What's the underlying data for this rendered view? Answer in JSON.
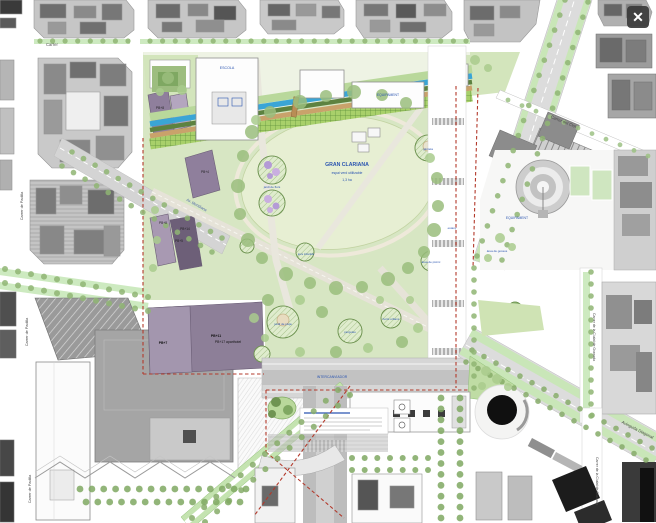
{
  "viewer": {
    "close_label": "✕"
  },
  "plan": {
    "title": "Pla urbanístic Glòries",
    "labels": [
      {
        "id": "carrer-top",
        "text": "Carrer",
        "x": 46,
        "y": 46,
        "rot": 0,
        "size": 4.2,
        "color": "#555555",
        "bold": false,
        "anchor": "start"
      },
      {
        "id": "carrer-del-clot",
        "text": "Carrer del Clot",
        "x": 563,
        "y": 123,
        "rot": 22,
        "size": 4.2,
        "color": "#4a4a4a",
        "bold": false,
        "anchor": "middle"
      },
      {
        "id": "carrer-padilla-1",
        "text": "Carrer de Padilla",
        "x": 23,
        "y": 206,
        "rot": -90,
        "size": 3.8,
        "color": "#4a4a4a",
        "bold": false,
        "anchor": "middle"
      },
      {
        "id": "carrer-padilla-2",
        "text": "Carrer de Padilla",
        "x": 28,
        "y": 332,
        "rot": -90,
        "size": 3.8,
        "color": "#4a4a4a",
        "bold": false,
        "anchor": "middle"
      },
      {
        "id": "carrer-padilla-3",
        "text": "Carrer de Padilla",
        "x": 31,
        "y": 489,
        "rot": -90,
        "size": 3.8,
        "color": "#4a4a4a",
        "bold": false,
        "anchor": "middle"
      },
      {
        "id": "carrer-granada-1",
        "text": "Carrer de la Ciutat de Granada",
        "x": 593,
        "y": 337,
        "rot": 90,
        "size": 3.5,
        "color": "#4a4a4a",
        "bold": false,
        "anchor": "middle"
      },
      {
        "id": "carrer-granada-2",
        "text": "Carrer de la Ciutat de Granada",
        "x": 596,
        "y": 481,
        "rot": 90,
        "size": 3.5,
        "color": "#4a4a4a",
        "bold": false,
        "anchor": "middle"
      },
      {
        "id": "avinguda-diagonal",
        "text": "Avinguda Diagonal",
        "x": 637,
        "y": 431,
        "rot": 27,
        "size": 4.2,
        "color": "#4a4a4a",
        "bold": false,
        "anchor": "middle"
      },
      {
        "id": "av-meridiana",
        "text": "Av. Meridiana",
        "x": 196,
        "y": 206,
        "rot": 29,
        "size": 3.8,
        "color": "#4a63a8",
        "bold": false,
        "anchor": "middle"
      },
      {
        "id": "gran-clariana-title",
        "text": "GRAN CLARIANA",
        "x": 347,
        "y": 166,
        "rot": 0,
        "size": 5.2,
        "color": "#2b55b0",
        "bold": true,
        "anchor": "middle"
      },
      {
        "id": "gran-clariana-sub",
        "text": "espai verd utilitzable",
        "x": 347,
        "y": 174,
        "rot": 0,
        "size": 3.4,
        "color": "#2b55b0",
        "bold": false,
        "anchor": "middle"
      },
      {
        "id": "gran-clariana-area",
        "text": "1,3 ha",
        "x": 347,
        "y": 181,
        "rot": 0,
        "size": 3.4,
        "color": "#2b55b0",
        "bold": false,
        "anchor": "middle"
      },
      {
        "id": "escola",
        "text": "ESCOLA",
        "x": 227,
        "y": 69,
        "rot": 0,
        "size": 3.6,
        "color": "#2b55b0",
        "bold": false,
        "anchor": "middle"
      },
      {
        "id": "equipament-1",
        "text": "EQUIPAMENT",
        "x": 388,
        "y": 96,
        "rot": 0,
        "size": 3.4,
        "color": "#2b55b0",
        "bold": false,
        "anchor": "middle"
      },
      {
        "id": "equipament-2",
        "text": "EQUIPAMENT",
        "x": 517,
        "y": 219,
        "rot": 0,
        "size": 3.4,
        "color": "#2b55b0",
        "bold": false,
        "anchor": "middle"
      },
      {
        "id": "intercanviador",
        "text": "INTERCANVIADOR",
        "x": 332,
        "y": 378,
        "rot": 0,
        "size": 3.4,
        "color": "#2b55b0",
        "bold": false,
        "anchor": "middle"
      },
      {
        "id": "pb8-top",
        "text": "PB+8",
        "x": 160,
        "y": 109,
        "rot": 0,
        "size": 3.3,
        "color": "#1e1e1e",
        "bold": false,
        "anchor": "middle"
      },
      {
        "id": "pb4",
        "text": "PB+4",
        "x": 205,
        "y": 173,
        "rot": 0,
        "size": 3.2,
        "color": "#1e1e1e",
        "bold": false,
        "anchor": "middle"
      },
      {
        "id": "pb8",
        "text": "PB+8",
        "x": 163,
        "y": 224,
        "rot": 0,
        "size": 3.2,
        "color": "#1e1e1e",
        "bold": false,
        "anchor": "middle"
      },
      {
        "id": "pb14",
        "text": "PB+14",
        "x": 185,
        "y": 230,
        "rot": 0,
        "size": 3.2,
        "color": "#1e1e1e",
        "bold": false,
        "anchor": "middle"
      },
      {
        "id": "pb5",
        "text": "PB+5",
        "x": 179,
        "y": 242,
        "rot": 0,
        "size": 3.2,
        "color": "#1e1e1e",
        "bold": false,
        "anchor": "middle"
      },
      {
        "id": "pb7",
        "text": "PB+7",
        "x": 163,
        "y": 344,
        "rot": 0,
        "size": 3.4,
        "color": "#111111",
        "bold": true,
        "anchor": "middle"
      },
      {
        "id": "pb11",
        "text": "PB+11",
        "x": 216,
        "y": 337,
        "rot": 0,
        "size": 3.4,
        "color": "#111111",
        "bold": true,
        "anchor": "middle"
      },
      {
        "id": "pb17",
        "text": "PB+17 aparthotel",
        "x": 228,
        "y": 343,
        "rot": 0,
        "size": 3.4,
        "color": "#111111",
        "bold": false,
        "anchor": "middle"
      },
      {
        "id": "jocs-infantils",
        "text": "jocs infantils",
        "x": 306,
        "y": 255,
        "rot": 0,
        "size": 3,
        "color": "#2b55b0",
        "bold": false,
        "anchor": "middle"
      },
      {
        "id": "jardi-pluja",
        "text": "jardí de pluja",
        "x": 283,
        "y": 325,
        "rot": 0,
        "size": 3,
        "color": "#2b55b0",
        "bold": false,
        "anchor": "middle"
      },
      {
        "id": "pergoles",
        "text": "pèrgoles",
        "x": 350,
        "y": 333,
        "rot": 0,
        "size": 3,
        "color": "#2b55b0",
        "bold": false,
        "anchor": "middle"
      },
      {
        "id": "horts-urbans",
        "text": "horts urbans",
        "x": 391,
        "y": 320,
        "rot": 0,
        "size": 3,
        "color": "#2b55b0",
        "bold": false,
        "anchor": "middle"
      },
      {
        "id": "estany",
        "text": "estany",
        "x": 452,
        "y": 229,
        "rot": 0,
        "size": 3,
        "color": "#2b55b0",
        "bold": false,
        "anchor": "middle"
      },
      {
        "id": "glorieta",
        "text": "glorieta",
        "x": 428,
        "y": 150,
        "rot": 0,
        "size": 3,
        "color": "#2b55b0",
        "bold": false,
        "anchor": "middle"
      },
      {
        "id": "area-picnic",
        "text": "àrea de picnic",
        "x": 431,
        "y": 263,
        "rot": 0,
        "size": 3,
        "color": "#2b55b0",
        "bold": false,
        "anchor": "middle"
      },
      {
        "id": "area-gossos",
        "text": "àrea de gossos",
        "x": 497,
        "y": 252,
        "rot": 0,
        "size": 3,
        "color": "#2b55b0",
        "bold": false,
        "anchor": "middle"
      },
      {
        "id": "jardi-flors",
        "text": "jardí de flors",
        "x": 272,
        "y": 188,
        "rot": 0,
        "size": 3,
        "color": "#2b55b0",
        "bold": false,
        "anchor": "middle"
      }
    ]
  }
}
